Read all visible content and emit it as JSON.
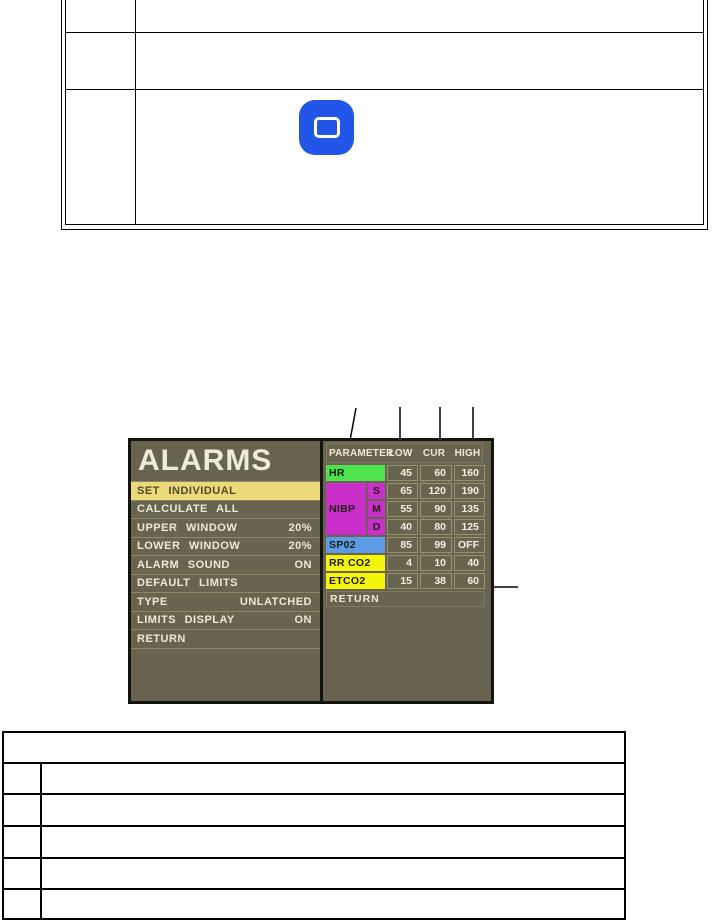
{
  "top_table": {
    "row_count": 3,
    "icon": "rounded-square-icon"
  },
  "figure": {
    "monitor": {
      "title": "ALARMS",
      "menu": [
        {
          "label": "SET INDIVIDUAL",
          "value": "",
          "selected": true
        },
        {
          "label": "CALCULATE ALL",
          "value": ""
        },
        {
          "label": "UPPER WINDOW",
          "value": "20%"
        },
        {
          "label": "LOWER WINDOW",
          "value": "20%"
        },
        {
          "label": "ALARM SOUND",
          "value": "ON"
        },
        {
          "label": "DEFAULT LIMITS",
          "value": ""
        },
        {
          "label": "TYPE",
          "value": "UNLATCHED"
        },
        {
          "label": "LIMITS DISPLAY",
          "value": "ON"
        },
        {
          "label": "RETURN",
          "value": ""
        }
      ],
      "limits": {
        "headers": [
          "PARAMETER",
          "LOW",
          "CUR",
          "HIGH"
        ],
        "rows": [
          {
            "param": "HR",
            "sub": "",
            "low": "45",
            "cur": "60",
            "high": "160",
            "color": "#4ce34c"
          },
          {
            "param": "NIBP",
            "sub": "S",
            "low": "65",
            "cur": "120",
            "high": "190",
            "color": "#cb2fcb"
          },
          {
            "param": "",
            "sub": "M",
            "low": "55",
            "cur": "90",
            "high": "135",
            "color": "#cb2fcb"
          },
          {
            "param": "",
            "sub": "D",
            "low": "40",
            "cur": "80",
            "high": "125",
            "color": "#cb2fcb"
          },
          {
            "param": "SP02",
            "sub": "",
            "low": "85",
            "cur": "99",
            "high": "OFF",
            "color": "#5e9be6"
          },
          {
            "param": "RR CO2",
            "sub": "",
            "low": "4",
            "cur": "10",
            "high": "40",
            "color": "#f5f50a"
          },
          {
            "param": "ETCO2",
            "sub": "",
            "low": "15",
            "cur": "38",
            "high": "60",
            "color": "#f5f50a"
          }
        ],
        "footer": "RETURN"
      }
    }
  },
  "bottom_table": {
    "body_rows": 5
  },
  "colors": {
    "monitor_background": "#696450",
    "monitor_text": "#ece9d6",
    "selected_item_background": "#ecda7a",
    "selected_item_text": "#4f4a2a",
    "hr_row": "#4ce34c",
    "nibp_row": "#cb2fcb",
    "spo2_row": "#5e9be6",
    "co2_rows": "#f5f50a",
    "icon_blue": "#2156e8"
  }
}
